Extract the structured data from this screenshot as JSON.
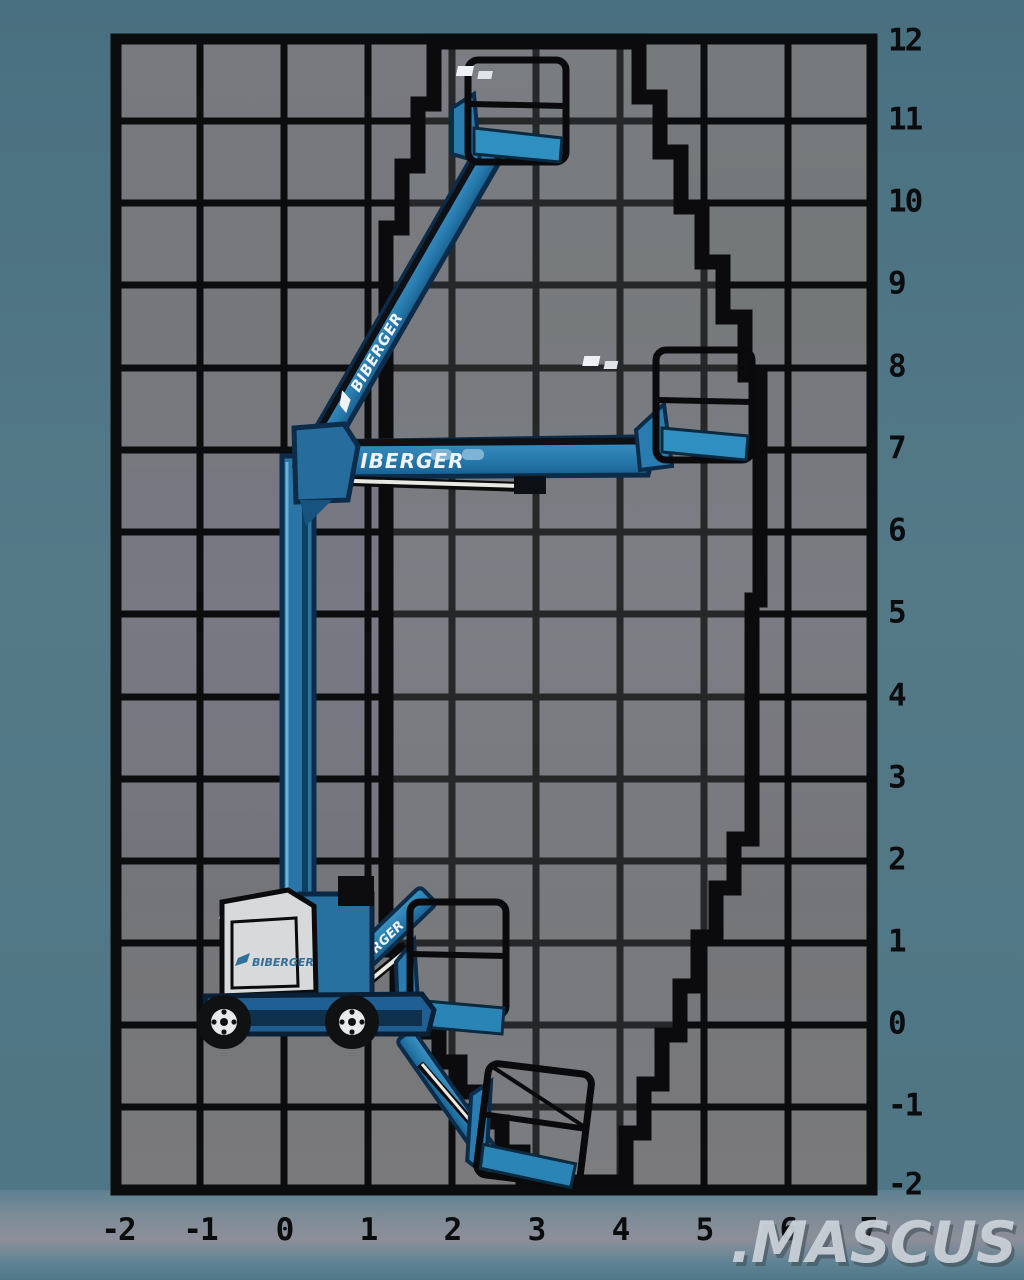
{
  "diagram": {
    "kind": "boom-lift working envelope diagram",
    "brand": {
      "name": "BIBERGER"
    },
    "watermark": {
      "text": ".MASCUS"
    },
    "axes": {
      "right_labels": [
        "12",
        "11",
        "10",
        "9",
        "8",
        "7",
        "6",
        "5",
        "4",
        "3",
        "2",
        "1",
        "0",
        "-1",
        "-2"
      ],
      "bottom_labels": [
        "-2",
        "-1",
        "0",
        "1",
        "2",
        "3",
        "4",
        "5",
        "6",
        "7"
      ],
      "height_range": [
        -2,
        12
      ],
      "reach_range": [
        -2,
        7
      ]
    },
    "colors": {
      "outer_teal": "#53798a",
      "grid_grey": "#77787b",
      "grid_line": "#0b0c0e",
      "machine_blue": "#2a7cb0",
      "machine_dark": "#0e3450",
      "panel_white": "#d7d9da",
      "watermark_grey": "#ccd2d9"
    }
  }
}
